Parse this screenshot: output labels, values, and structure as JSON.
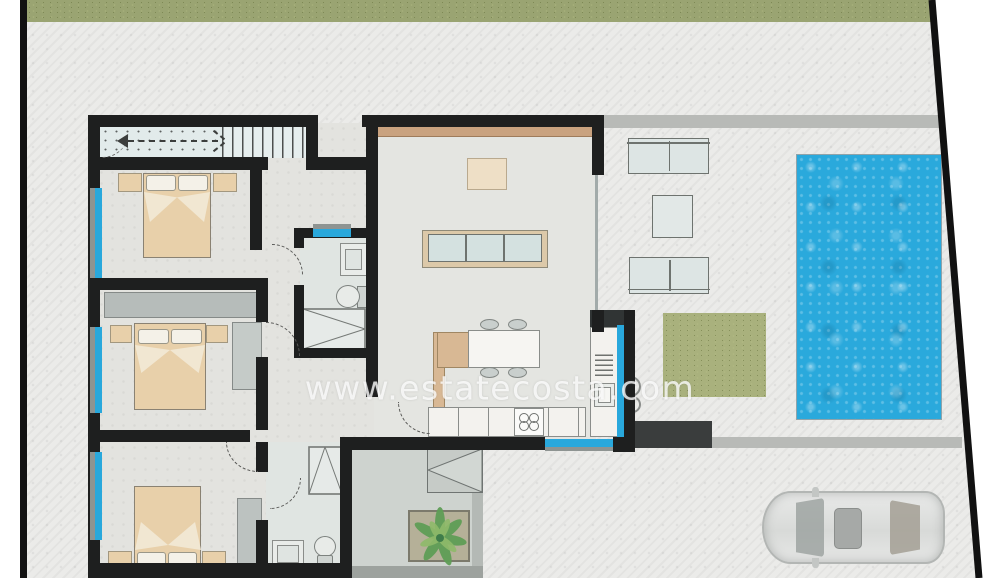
{
  "watermark": {
    "text": "www.estatecosta.com"
  },
  "palette": {
    "boundary_wall": "#111111",
    "interior_wall": "#1e1f1f",
    "window_blue": "#29a8dc",
    "pool_blue": "#2aa9dc",
    "grass_band_green": "#9aa472",
    "grass_patch_green": "#a9b17d",
    "concrete_gray": "#ebebe9",
    "patio_gray": "#ced3cf",
    "path_gray": "#b8bab7",
    "furniture_tan": "#e8d0aa",
    "wood_beam": "#c9a27f",
    "sofa_blue_gray": "#dde5e4",
    "car_silver": "#dcdddc"
  },
  "features": [
    "staircase",
    "bedroom-1-double-bed",
    "bedroom-2-double-bed",
    "bedroom-3-double-bed",
    "bathroom-1-shower-toilet-sink",
    "bathroom-2-shower-toilet-sink",
    "living-room-sofa",
    "living-room-rug",
    "kitchen-island-dining-table",
    "kitchen-counter-stove",
    "kitchen-tall-units",
    "terrace-sofas-and-table",
    "swimming-pool",
    "lawn-patch",
    "courtyard-plant",
    "parked-car",
    "driveway-path"
  ]
}
